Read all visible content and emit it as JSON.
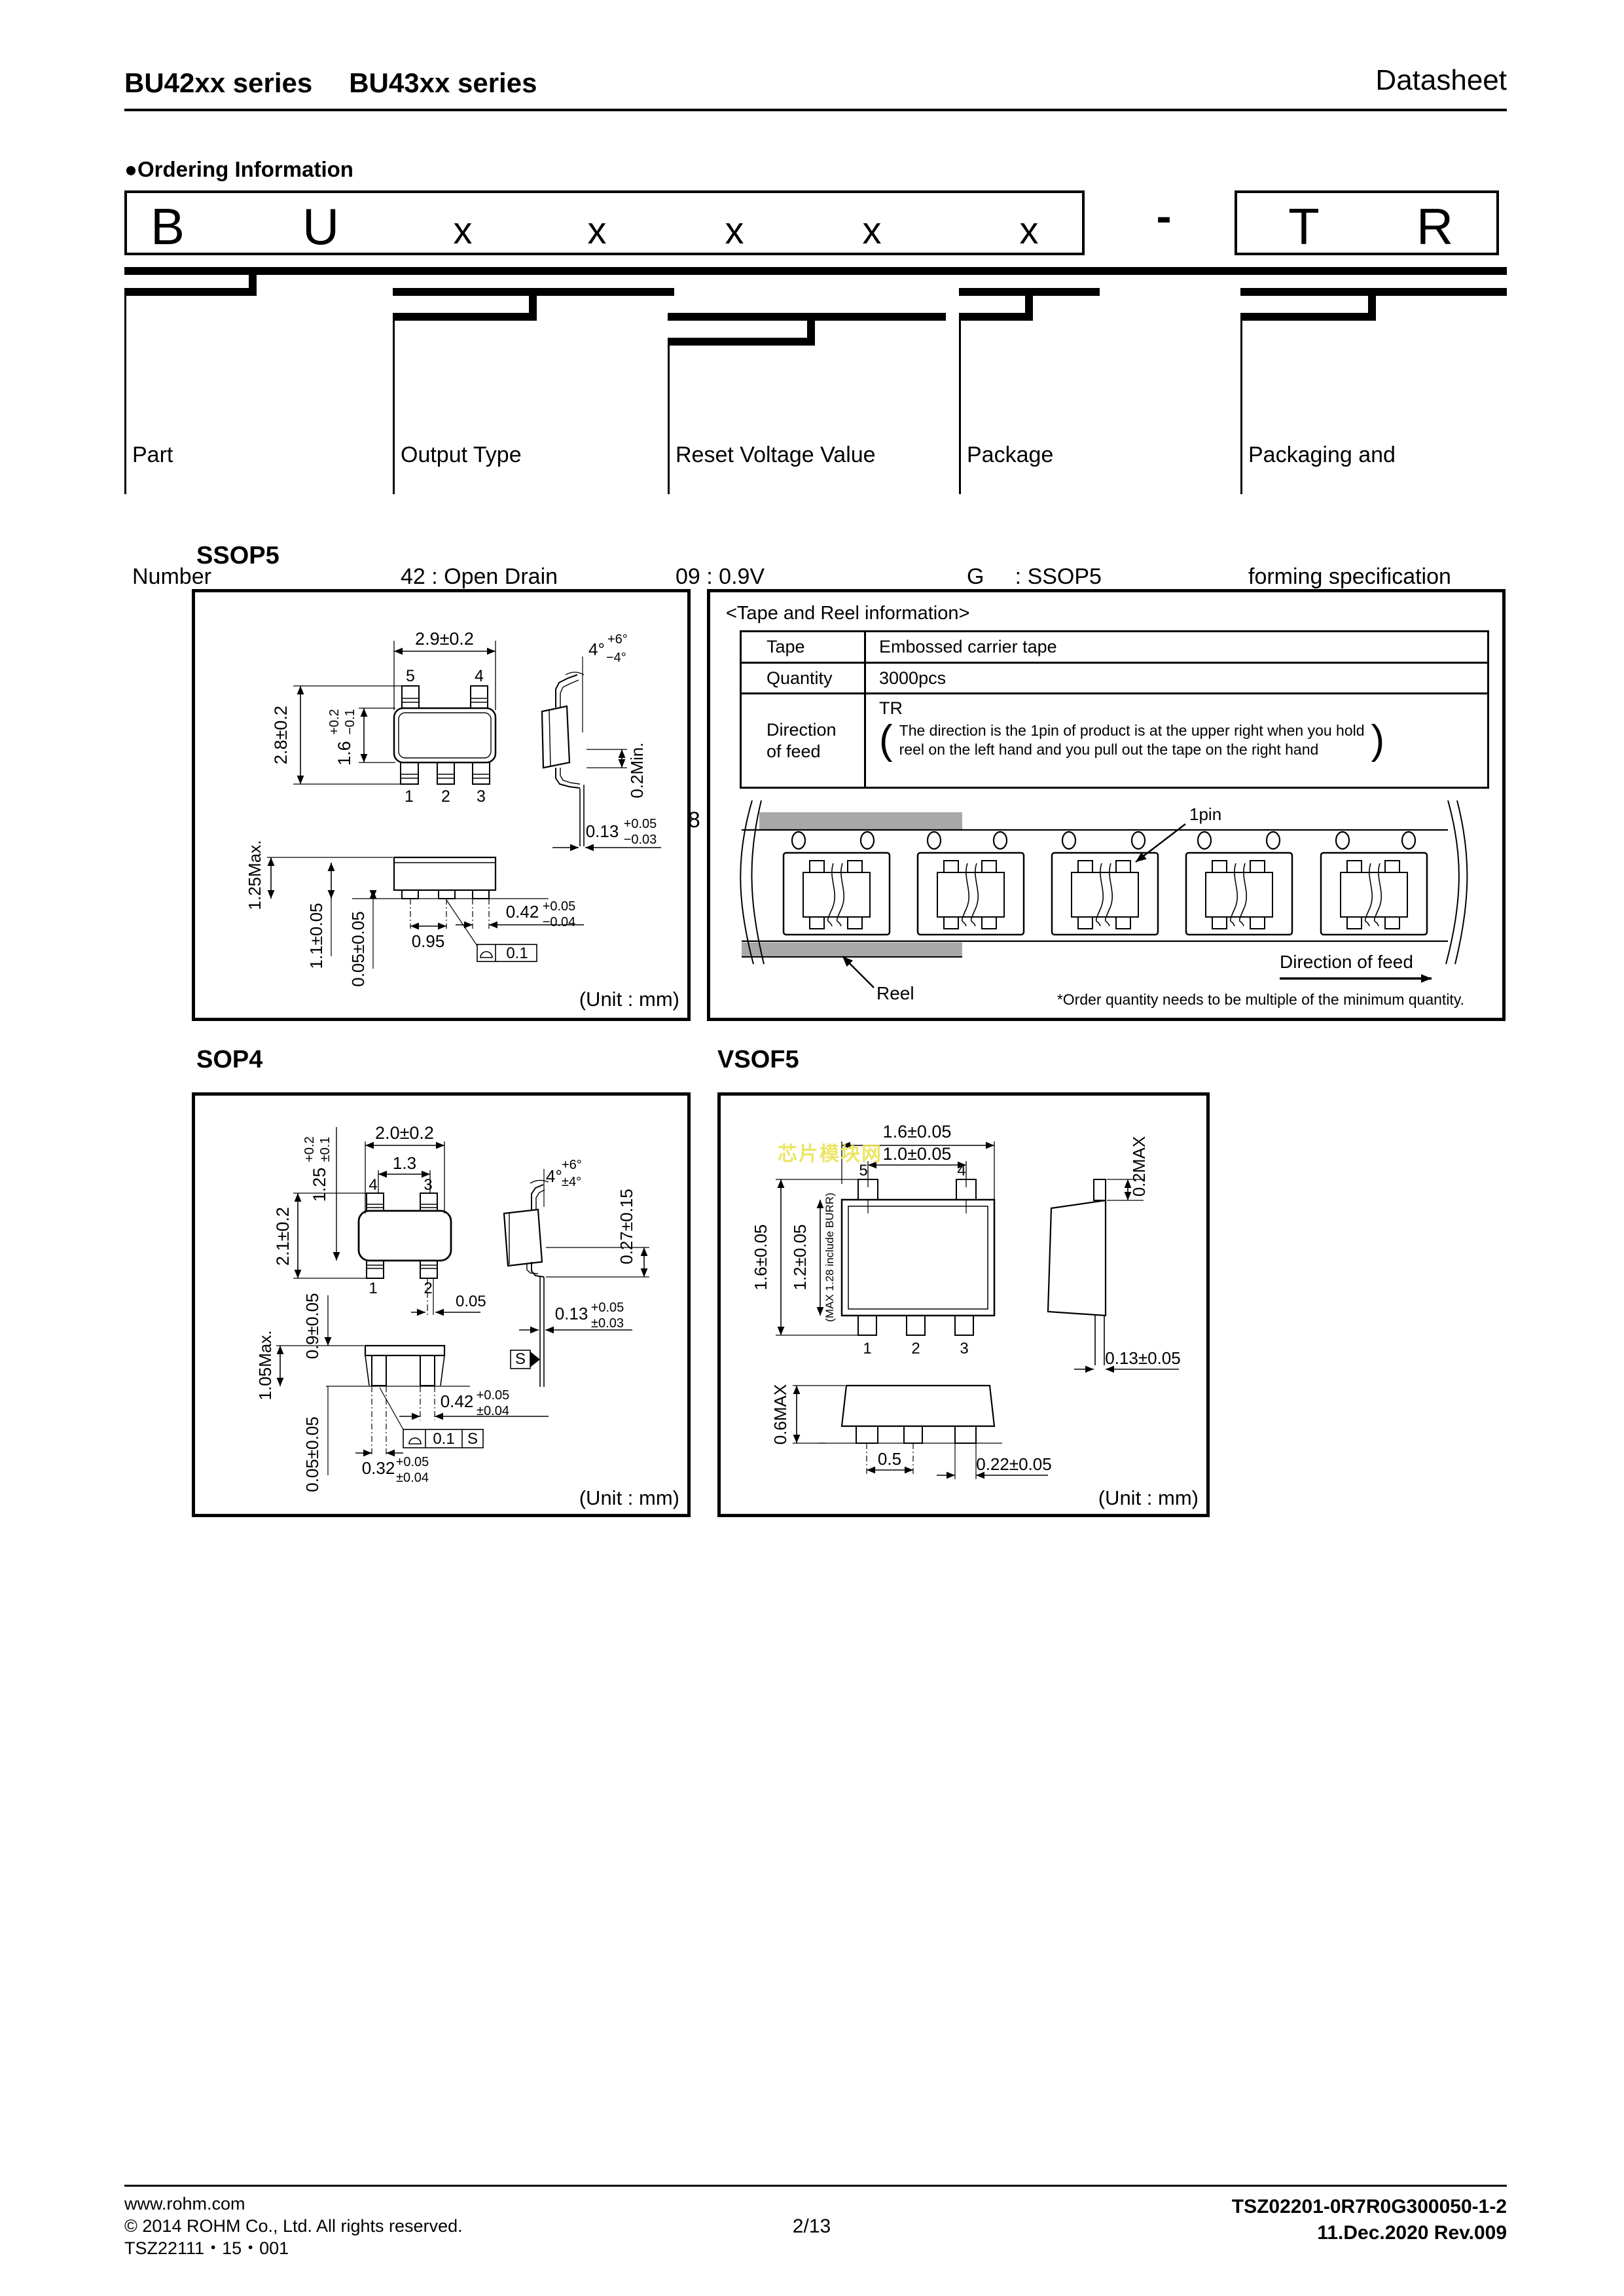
{
  "header": {
    "series_left": "BU42xx series",
    "series_right": "BU43xx series",
    "doc_type": "Datasheet"
  },
  "ordering": {
    "bullet": "●",
    "title": "Ordering Information",
    "code": [
      "B",
      "U",
      "x",
      "x",
      "x",
      "x",
      "x"
    ],
    "dash": "-",
    "suffix": [
      "T",
      "R"
    ],
    "cols": [
      {
        "lines": [
          "Part",
          "Number"
        ]
      },
      {
        "lines": [
          "Output Type",
          "42 : Open Drain",
          "43 : CMOS"
        ]
      },
      {
        "lines": [
          "Reset Voltage Value",
          "09 : 0.9V",
          "           ⇩      0.1V step",
          "48 : 4.8V"
        ]
      },
      {
        "lines": [
          "Package",
          "G     : SSOP5",
          "F     : SOP4",
          "FVE : VSOF5"
        ]
      },
      {
        "lines": [
          "Packaging and",
          "forming specification",
          "TR : Embossed tape",
          "              and reel"
        ]
      }
    ]
  },
  "ssop5": {
    "title": "SSOP5",
    "dim_top_width": "2.9±0.2",
    "pin5": "5",
    "pin4": "4",
    "pin1": "1",
    "pin2": "2",
    "pin3": "3",
    "dim_overall": "2.8±0.2",
    "dim_body": "1.6",
    "dim_body_tp": "+0.2",
    "dim_body_tm": "−0.1",
    "angle": "4°",
    "angle_tp": "+6°",
    "angle_tm": "−4°",
    "dim_standoff_side": "0.2Min.",
    "dim_lead_thk": "0.13",
    "dim_lead_thk_tp": "+0.05",
    "dim_lead_thk_tm": "−0.03",
    "dim_height": "1.25Max.",
    "dim_body_front": "1.1±0.05",
    "dim_standoff": "0.05±0.05",
    "dim_pitch": "0.95",
    "dim_lead_w": "0.42",
    "dim_lead_w_tp": "+0.05",
    "dim_lead_w_tm": "−0.04",
    "flatness": "0.1",
    "unit": "(Unit : mm)"
  },
  "tape_reel": {
    "title": "<Tape and Reel information>",
    "tape_label": "Tape",
    "tape_value": "Embossed carrier tape",
    "qty_label": "Quantity",
    "qty_value": "3000pcs",
    "dir_label_1": "Direction",
    "dir_label_2": "of feed",
    "dir_value": "TR",
    "paren_open": "(",
    "paren_close": ")",
    "dir_note_1": "The direction is the 1pin of product is at the upper right when you hold",
    "dir_note_2": "reel on the left hand and you pull out the tape on the right hand",
    "pin1_callout": "1pin",
    "reel_callout": "Reel",
    "feed_callout": "Direction of feed",
    "order_note": "*Order quantity needs to be multiple of the minimum quantity."
  },
  "sop4": {
    "title": "SOP4",
    "dim_top_width": "2.0±0.2",
    "dim_pitch_top": "1.3",
    "dim_body": "1.25",
    "dim_body_tp": "+0.2",
    "dim_body_tm": "±0.1",
    "dim_overall": "2.1±0.2",
    "pin4": "4",
    "pin3": "3",
    "pin1": "1",
    "pin2": "2",
    "dim_offset": "0.05",
    "angle": "4°",
    "angle_tp": "+6°",
    "angle_tm": "±4°",
    "dim_lead_len": "0.27±0.15",
    "dim_lead_thk": "0.13",
    "dim_lead_thk_tp": "+0.05",
    "dim_lead_thk_tm": "±0.03",
    "dim_body_front": "0.9±0.05",
    "dim_height": "1.05Max.",
    "dim_standoff": "0.05±0.05",
    "dim_lead_w": "0.42",
    "dim_lead_w_tp": "+0.05",
    "dim_lead_w_tm": "±0.04",
    "dim_lead_w2": "0.32",
    "dim_lead_w2_tp": "+0.05",
    "dim_lead_w2_tm": "±0.04",
    "flatness": "0.1",
    "datum": "S",
    "unit": "(Unit : mm)"
  },
  "vsof5": {
    "title": "VSOF5",
    "watermark": "芯片模块网",
    "dim_top_width": "1.6±0.05",
    "dim_pitch_top": "1.0±0.05",
    "pin5": "5",
    "pin4": "4",
    "pin1": "1",
    "pin2": "2",
    "pin3": "3",
    "dim_overall": "1.6±0.05",
    "dim_body": "1.2±0.05",
    "dim_burr": "(MAX 1.28 include BURR)",
    "dim_top_right": "0.2MAX",
    "dim_lead_thk": "0.13±0.05",
    "dim_height": "0.6MAX",
    "dim_pitch": "0.5",
    "dim_lead_w": "0.22±0.05",
    "unit": "(Unit : mm)"
  },
  "footer": {
    "url": "www.rohm.com",
    "copyright": "© 2014 ROHM Co., Ltd. All rights reserved.",
    "doc_code": "TSZ22111・15・001",
    "page": "2/13",
    "doc_number": "TSZ02201-0R7R0G300050-1-2",
    "revision": "11.Dec.2020 Rev.009"
  }
}
